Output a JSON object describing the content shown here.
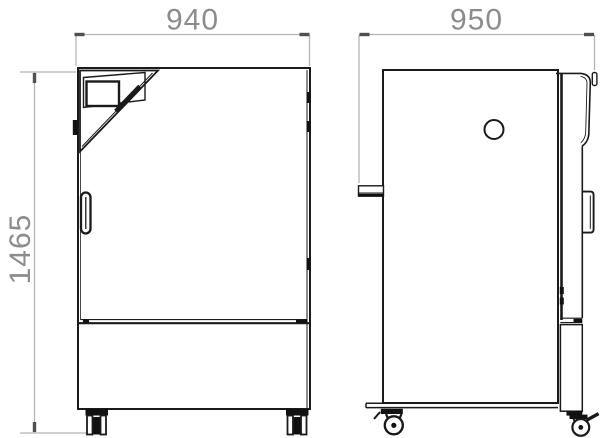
{
  "drawing": {
    "kind": "technical dimension drawing, front and side elevation of a floor-standing climate cabinet on casters"
  },
  "dimensions": {
    "front_width": "940",
    "side_depth": "950",
    "overall_height": "1465"
  },
  "colors": {
    "line": "#1a1a1a",
    "dimension_line": "#b3b3b3",
    "dimension_tick": "#4f4f4f",
    "dimension_text": "#8c8c8c",
    "background": "#ffffff"
  }
}
